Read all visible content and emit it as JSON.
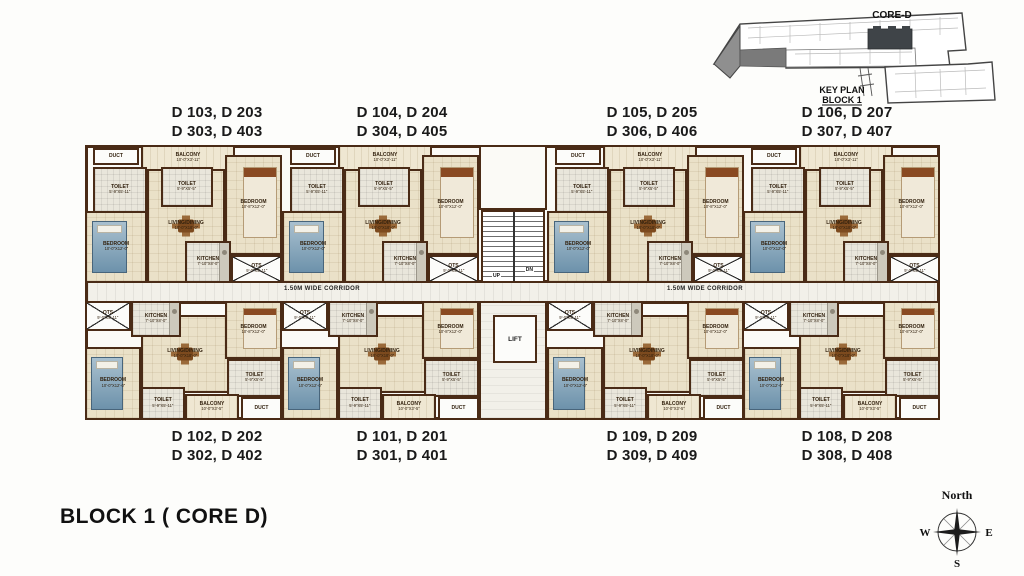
{
  "title": "BLOCK 1 ( CORE D)",
  "key_plan": {
    "core_label": "CORE-D",
    "caption_line1": "KEY PLAN",
    "caption_line2": "BLOCK 1"
  },
  "compass": {
    "north": "North",
    "west": "W",
    "east": "E",
    "south": "S"
  },
  "corridor": {
    "label": "1.50M WIDE CORRIDOR"
  },
  "core": {
    "lift": "LIFT",
    "up": "UP",
    "dn": "DN"
  },
  "units_top": [
    {
      "line1": "D 103, D 203",
      "line2": "D 303, D 403"
    },
    {
      "line1": "D 104, D 204",
      "line2": "D 304, D 405"
    },
    {
      "line1": "D 105, D 205",
      "line2": "D 306, D 406"
    },
    {
      "line1": "D 106, D 207",
      "line2": "D 307, D 407"
    }
  ],
  "units_bottom": [
    {
      "line1": "D 102, D 202",
      "line2": "D 302, D 402"
    },
    {
      "line1": "D 101, D 201",
      "line2": "D 301, D 401"
    },
    {
      "line1": "D 109, D 209",
      "line2": "D 309, D 409"
    },
    {
      "line1": "D 108, D 208",
      "line2": "D 308, D 408"
    }
  ],
  "room_templates": {
    "top": [
      {
        "name": "living",
        "label": "LIVING/DINING",
        "dim": "10'-0\"X18'-0\"",
        "x": 62,
        "y": 24,
        "w": 78,
        "h": 114,
        "floor": "cream",
        "furn": "dining"
      },
      {
        "name": "balcony",
        "label": "BALCONY",
        "dim": "10'-0\"X3'-11\"",
        "x": 56,
        "y": 0,
        "w": 94,
        "h": 26,
        "floor": "balc",
        "furn": ""
      },
      {
        "name": "duct",
        "label": "DUCT",
        "dim": "",
        "x": 8,
        "y": 3,
        "w": 46,
        "h": 17,
        "floor": "white",
        "furn": ""
      },
      {
        "name": "toilet",
        "label": "TOILET",
        "dim": "5'-9\"X5'-11\"",
        "x": 8,
        "y": 22,
        "w": 54,
        "h": 46,
        "floor": "tile",
        "furn": ""
      },
      {
        "name": "toilet",
        "label": "TOILET",
        "dim": "5'-9\"X5'-5\"",
        "x": 76,
        "y": 22,
        "w": 52,
        "h": 40,
        "floor": "tile",
        "furn": ""
      },
      {
        "name": "bedroom",
        "label": "BEDROOM",
        "dim": "10'-8\"X12'-0\"",
        "x": 140,
        "y": 10,
        "w": 57,
        "h": 100,
        "floor": "cream",
        "furn": "bed-light"
      },
      {
        "name": "bedroom",
        "label": "BEDROOM",
        "dim": "10'-0\"X12'-0\"",
        "x": 0,
        "y": 66,
        "w": 62,
        "h": 72,
        "floor": "cream",
        "furn": "bed-blue"
      },
      {
        "name": "kitchen",
        "label": "KITCHEN",
        "dim": "7'-10\"X8'-0\"",
        "x": 100,
        "y": 96,
        "w": 46,
        "h": 42,
        "floor": "tile",
        "furn": "counter"
      },
      {
        "name": "ots",
        "label": "OTS",
        "dim": "9'-0\"X5'-11\"",
        "x": 146,
        "y": 110,
        "w": 51,
        "h": 28,
        "floor": "white",
        "furn": "cross"
      }
    ],
    "bottom": [
      {
        "name": "living",
        "label": "LIVING/DINING",
        "dim": "10'-0\"X18'-0\"",
        "x": 56,
        "y": 14,
        "w": 88,
        "h": 78,
        "floor": "cream",
        "furn": "dining"
      },
      {
        "name": "ots",
        "label": "OTS",
        "dim": "9'-0\"X5'-11\"",
        "x": 0,
        "y": 0,
        "w": 46,
        "h": 30,
        "floor": "white",
        "furn": "cross"
      },
      {
        "name": "kitchen",
        "label": "KITCHEN",
        "dim": "7'-10\"X8'-0\"",
        "x": 46,
        "y": 0,
        "w": 50,
        "h": 36,
        "floor": "tile",
        "furn": "counter"
      },
      {
        "name": "bedroom",
        "label": "BEDROOM",
        "dim": "10'-8\"X12'-0\"",
        "x": 140,
        "y": 0,
        "w": 57,
        "h": 58,
        "floor": "cream",
        "furn": "bed-light"
      },
      {
        "name": "bedroom",
        "label": "BEDROOM",
        "dim": "10'-0\"X12'-0\"",
        "x": 0,
        "y": 46,
        "w": 56,
        "h": 73,
        "floor": "cream",
        "furn": "bed-blue"
      },
      {
        "name": "toilet",
        "label": "TOILET",
        "dim": "5'-9\"X5'-11\"",
        "x": 56,
        "y": 86,
        "w": 44,
        "h": 33,
        "floor": "tile",
        "furn": ""
      },
      {
        "name": "toilet",
        "label": "TOILET",
        "dim": "5'-9\"X5'-5\"",
        "x": 142,
        "y": 58,
        "w": 55,
        "h": 38,
        "floor": "tile",
        "furn": ""
      },
      {
        "name": "balcony",
        "label": "BALCONY",
        "dim": "10'-0\"X3'-5\"",
        "x": 100,
        "y": 93,
        "w": 54,
        "h": 26,
        "floor": "balc",
        "furn": ""
      },
      {
        "name": "duct",
        "label": "DUCT",
        "dim": "",
        "x": 156,
        "y": 96,
        "w": 41,
        "h": 23,
        "floor": "white",
        "furn": ""
      }
    ]
  },
  "layout": {
    "unit_lefts": [
      85,
      282,
      462,
      658
    ],
    "unit_lefts_abs": [
      85,
      282,
      547,
      743
    ],
    "unit_widths": [
      197,
      197,
      196,
      197
    ],
    "top_band_y": 145,
    "top_unit_h": 138,
    "bottom_band_y": 301,
    "bottom_unit_h": 119,
    "label_centers": [
      217,
      402,
      652,
      847
    ],
    "top_label_y": 103,
    "bottom_label_y": 427,
    "corridor_label_x": [
      322,
      705
    ]
  },
  "colors": {
    "wall": "#4a2b16",
    "floor": "#eae1c8",
    "corridor": "#f2f0e9",
    "bed_accent": "#6d92ab"
  }
}
